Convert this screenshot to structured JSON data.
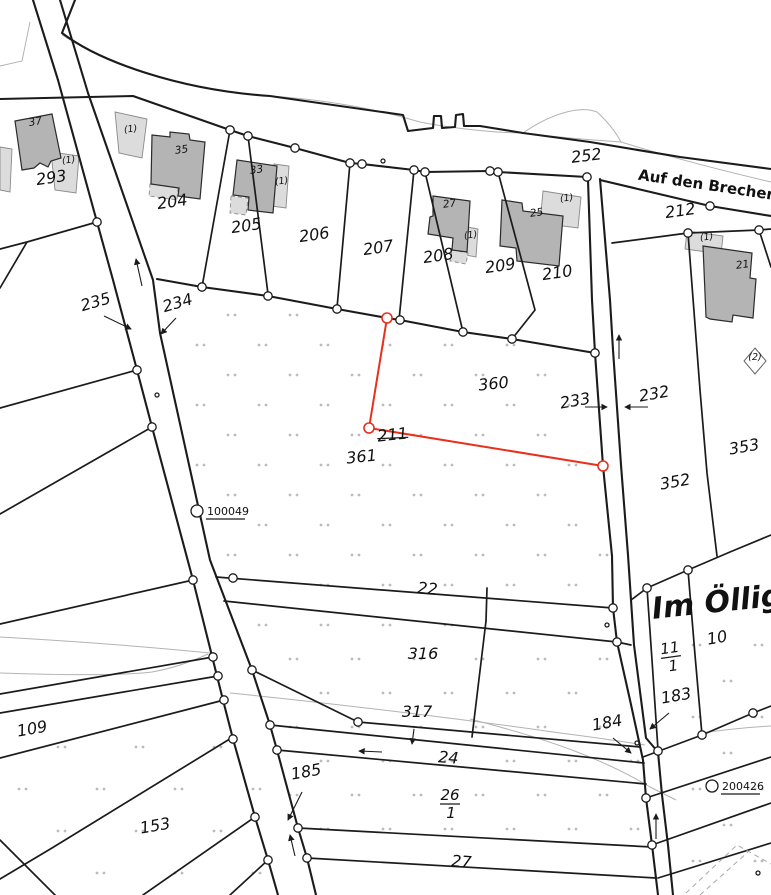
{
  "map_type": "cadastral-parcel-map",
  "colors": {
    "highlight_red": "#e8301d",
    "line_black": "#1b1b1b",
    "building_fill": "#b4b4b4",
    "annex_fill": "#dcdcdc",
    "thin_gray": "#b3b3b3",
    "dot_gray": "#bcbcbc"
  },
  "streets": [
    {
      "name": "Auf den Brechen",
      "x": 707,
      "y": 190,
      "rot": 8.5,
      "size": 15
    },
    {
      "name": "Im Öllig",
      "x": 718,
      "y": 612,
      "rot": -6,
      "size": 30
    }
  ],
  "highlighted_parcel": {
    "number": "360",
    "color": "#e8301d"
  },
  "parcel_labels": [
    {
      "text": "293",
      "x": 52,
      "y": 183,
      "rot": -8
    },
    {
      "text": "204",
      "x": 173,
      "y": 207,
      "rot": -8
    },
    {
      "text": "205",
      "x": 247,
      "y": 231,
      "rot": -8
    },
    {
      "text": "206",
      "x": 315,
      "y": 240,
      "rot": -8
    },
    {
      "text": "207",
      "x": 379,
      "y": 253,
      "rot": -8
    },
    {
      "text": "208",
      "x": 439,
      "y": 261,
      "rot": -8
    },
    {
      "text": "209",
      "x": 501,
      "y": 271,
      "rot": -8
    },
    {
      "text": "210",
      "x": 558,
      "y": 278,
      "rot": -8
    },
    {
      "text": "252",
      "x": 587,
      "y": 161,
      "rot": -7
    },
    {
      "text": "212",
      "x": 681,
      "y": 216,
      "rot": -8
    },
    {
      "text": "235",
      "x": 97,
      "y": 307,
      "rot": -16
    },
    {
      "text": "234",
      "x": 179,
      "y": 308,
      "rot": -16
    },
    {
      "text": "233",
      "x": 576,
      "y": 406,
      "rot": -10
    },
    {
      "text": "232",
      "x": 655,
      "y": 399,
      "rot": -10
    },
    {
      "text": "360",
      "x": 494,
      "y": 389,
      "rot": -6,
      "color": "#e8301d"
    },
    {
      "text": "361",
      "x": 362,
      "y": 462,
      "rot": -6,
      "color": "#e8301d"
    },
    {
      "text": "211",
      "x": 393,
      "y": 440,
      "rot": -6,
      "struck": true
    },
    {
      "text": "352",
      "x": 676,
      "y": 487,
      "rot": -10
    },
    {
      "text": "353",
      "x": 745,
      "y": 452,
      "rot": -10
    },
    {
      "text": "22",
      "x": 427,
      "y": 594,
      "rot": 5
    },
    {
      "text": "316",
      "x": 423,
      "y": 659,
      "rot": 0
    },
    {
      "text": "317",
      "x": 417,
      "y": 717,
      "rot": 0
    },
    {
      "text": "24",
      "x": 448,
      "y": 763,
      "rot": 4
    },
    {
      "text": "27",
      "x": 461,
      "y": 867,
      "rot": 4
    },
    {
      "text": "109",
      "x": 33,
      "y": 734,
      "rot": -10
    },
    {
      "text": "153",
      "x": 156,
      "y": 831,
      "rot": -10
    },
    {
      "text": "185",
      "x": 307,
      "y": 777,
      "rot": -10
    },
    {
      "text": "183",
      "x": 677,
      "y": 701,
      "rot": -10
    },
    {
      "text": "184",
      "x": 608,
      "y": 728,
      "rot": -10
    },
    {
      "text": "10",
      "x": 718,
      "y": 643,
      "rot": -10
    }
  ],
  "fraction_labels": [
    {
      "num": "26",
      "den": "1",
      "x": 450,
      "y": 804,
      "rot": 0
    },
    {
      "num": "11",
      "den": "1",
      "x": 671,
      "y": 657,
      "rot": -8
    }
  ],
  "building_labels": [
    {
      "text": "37",
      "x": 36,
      "y": 125,
      "rot": -10
    },
    {
      "text": "35",
      "x": 182,
      "y": 153,
      "rot": -8
    },
    {
      "text": "33",
      "x": 257,
      "y": 173,
      "rot": -8
    },
    {
      "text": "27",
      "x": 450,
      "y": 207,
      "rot": -8
    },
    {
      "text": "25",
      "x": 537,
      "y": 216,
      "rot": -8
    },
    {
      "text": "21",
      "x": 743,
      "y": 268,
      "rot": -8
    }
  ],
  "annex_labels": [
    {
      "text": "(1)",
      "x": 69,
      "y": 163,
      "rot": -8
    },
    {
      "text": "(1)",
      "x": 131,
      "y": 132,
      "rot": -8
    },
    {
      "text": "(1)",
      "x": 282,
      "y": 184,
      "rot": -8
    },
    {
      "text": "(1)",
      "x": 471,
      "y": 238,
      "rot": -8
    },
    {
      "text": "(1)",
      "x": 567,
      "y": 201,
      "rot": -8
    },
    {
      "text": "(1)",
      "x": 707,
      "y": 240,
      "rot": -8
    }
  ],
  "symbol_labels": [
    {
      "text": "(2)",
      "x": 755,
      "y": 360,
      "rot": 0
    }
  ],
  "point_markers": [
    {
      "id": "100049",
      "cx": 197,
      "cy": 511
    },
    {
      "id": "200426",
      "cx": 712,
      "cy": 786
    }
  ]
}
